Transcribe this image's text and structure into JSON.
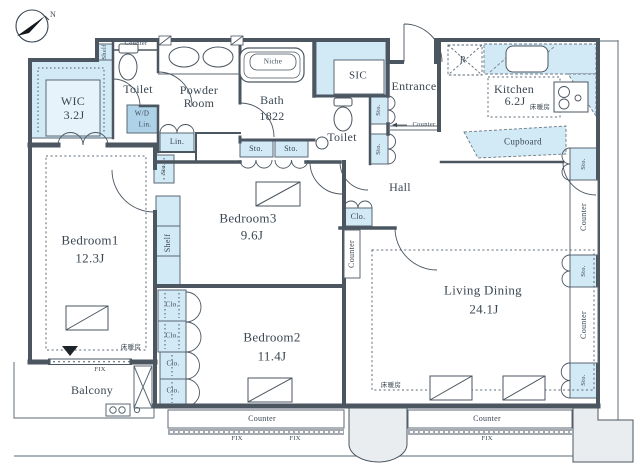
{
  "compass": {
    "north": "N"
  },
  "rooms": {
    "wic": {
      "name": "WIC",
      "size": "3.2J"
    },
    "toilet_a": {
      "name": "Toilet"
    },
    "powder": {
      "name_line1": "Powder",
      "name_line2": "Room"
    },
    "bath": {
      "name": "Bath",
      "size": "1822"
    },
    "sic": {
      "name": "SIC"
    },
    "toilet_b": {
      "name": "Toilet"
    },
    "entrance": {
      "name": "Entrance"
    },
    "kitchen": {
      "name": "Kitchen",
      "size": "6.2J"
    },
    "hall": {
      "name": "Hall"
    },
    "bedroom1": {
      "name": "Bedroom1",
      "size": "12.3J"
    },
    "bedroom2": {
      "name": "Bedroom2",
      "size": "11.4J"
    },
    "bedroom3": {
      "name": "Bedroom3",
      "size": "9.6J"
    },
    "living_dining": {
      "name": "Living Dining",
      "size": "24.1J"
    },
    "balcony": {
      "name": "Balcony"
    }
  },
  "labels": {
    "counter": "Counter",
    "shelf": "Shelf",
    "sto": "Sto.",
    "clo": "Clo.",
    "lin": "Lin.",
    "wd": "W/D",
    "fix": "FIX",
    "niche": "Niche",
    "cupboard": "Cupboard",
    "fridge": "R",
    "floor_heating": "床暖房"
  },
  "colors": {
    "wall": "#4b5661",
    "storage_fill": "#d2e9f6",
    "storage_dark": "#aed3e8",
    "pillar": "#e9edf0",
    "text": "#3b4752"
  }
}
